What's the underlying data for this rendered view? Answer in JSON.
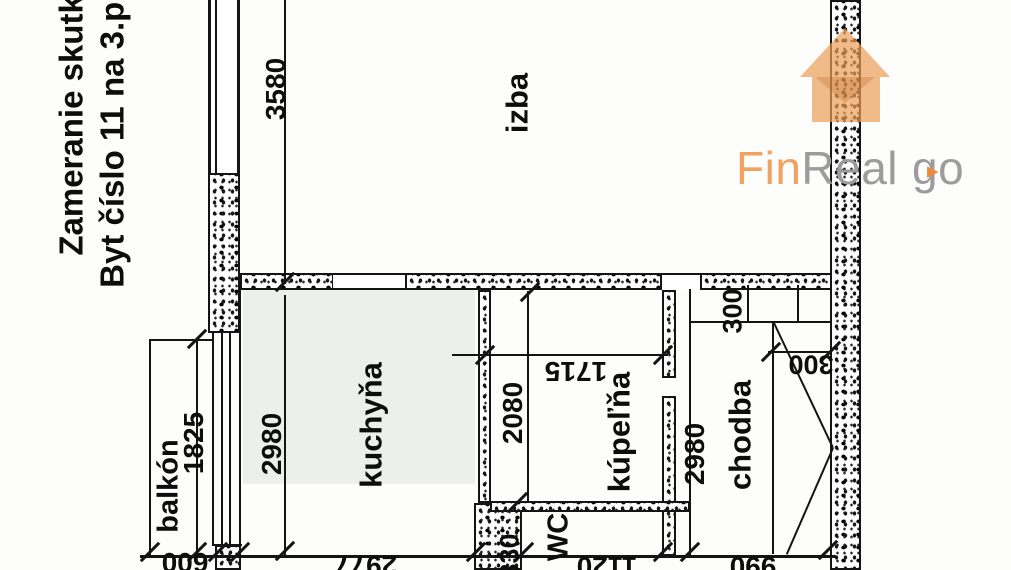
{
  "header": {
    "line1": "Zameranie skutkové",
    "line2": "Byt číslo 11 na 3.p. vchod"
  },
  "rooms": {
    "izba": "izba",
    "kuchyna": "kuchyňa",
    "kupelna": "kúpeľňa",
    "chodba": "chodba",
    "balkon": "balkón",
    "wc": "WC"
  },
  "dims": {
    "izba_width": "3580",
    "kuchyna_depth": "2980",
    "kupelna_depth": "2080",
    "kupelna_width": "1715",
    "balkon_length": "1825",
    "nika_depth": "300",
    "nika_width": "300",
    "chodba_depth": "2980",
    "balkon_width": "600",
    "kuchyna_width": "2977",
    "wc_wall": "330",
    "wc_width": "1120",
    "chodba_width": "990"
  },
  "logo": {
    "fin": "Fin",
    "real": "Real",
    "go": "go",
    "play_icon": "▶",
    "orange": "#f0a263",
    "gray": "#9c9c9c"
  }
}
